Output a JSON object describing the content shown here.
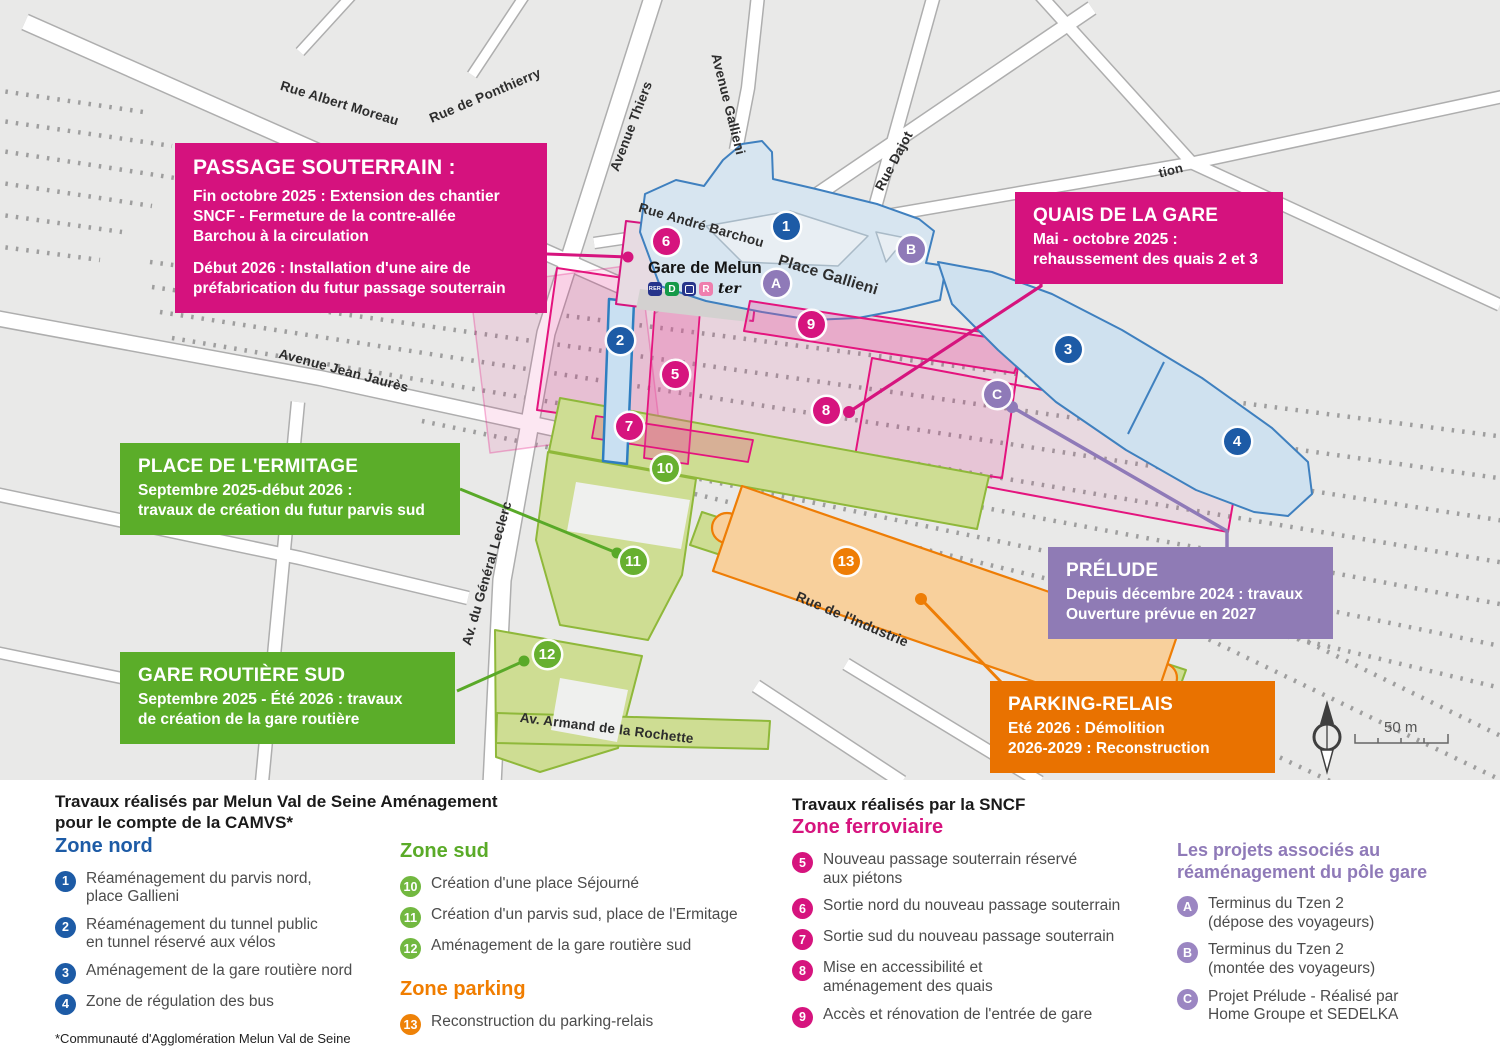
{
  "colors": {
    "blue": "#1d5ba6",
    "pink": "#d6147e",
    "green": "#67b02f",
    "orange": "#ee7d05",
    "purple": "#8f7ab8"
  },
  "map": {
    "scale_label": "50 m",
    "station": {
      "name": "Gare de Melun",
      "rer": "RER",
      "line_d": "D",
      "transilien_r": "R",
      "ter": "ter"
    },
    "street_labels": [
      {
        "text": "Rue Albert Moreau",
        "x": 283,
        "y": 78,
        "rot": 17,
        "size": 13.5
      },
      {
        "text": "Rue de Ponthierry",
        "x": 427,
        "y": 112,
        "rot": -23,
        "size": 13.5
      },
      {
        "text": "Avenue Thiers",
        "x": 607,
        "y": 168,
        "rot": -69,
        "size": 13.5
      },
      {
        "text": "Avenue Gallieni",
        "x": 723,
        "y": 52,
        "rot": 76,
        "size": 13.5
      },
      {
        "text": "Rue Dajot",
        "x": 872,
        "y": 186,
        "rot": -62,
        "size": 13.5
      },
      {
        "text": "Rue André Barchou",
        "x": 641,
        "y": 200,
        "rot": 16,
        "size": 13.5
      },
      {
        "text": "Place Gallieni",
        "x": 781,
        "y": 252,
        "rot": 17,
        "size": 15.5
      },
      {
        "text": "Avenue Jean Jaurès",
        "x": 281,
        "y": 346,
        "rot": 15,
        "size": 13.5
      },
      {
        "text": "Av. du Général Leclerc",
        "x": 459,
        "y": 643,
        "rot": -74,
        "size": 13.5
      },
      {
        "text": "Rue de l'Industrie",
        "x": 800,
        "y": 588,
        "rot": 23,
        "size": 14
      },
      {
        "text": "Av. Armand de la Rochette",
        "x": 521,
        "y": 710,
        "rot": 7,
        "size": 13.5
      },
      {
        "text": "tion",
        "x": 1157,
        "y": 166,
        "rot": -14,
        "size": 13
      }
    ],
    "markers": [
      {
        "label": "1",
        "x": 786,
        "y": 226,
        "color": "blue"
      },
      {
        "label": "2",
        "x": 620,
        "y": 340,
        "color": "blue"
      },
      {
        "label": "3",
        "x": 1068,
        "y": 349,
        "color": "blue"
      },
      {
        "label": "4",
        "x": 1237,
        "y": 441,
        "color": "blue"
      },
      {
        "label": "5",
        "x": 675,
        "y": 374,
        "color": "pink"
      },
      {
        "label": "6",
        "x": 666,
        "y": 241,
        "color": "pink"
      },
      {
        "label": "7",
        "x": 629,
        "y": 426,
        "color": "pink"
      },
      {
        "label": "8",
        "x": 826,
        "y": 410,
        "color": "pink"
      },
      {
        "label": "9",
        "x": 811,
        "y": 324,
        "color": "pink"
      },
      {
        "label": "10",
        "x": 665,
        "y": 468,
        "color": "green"
      },
      {
        "label": "11",
        "x": 633,
        "y": 561,
        "color": "green"
      },
      {
        "label": "12",
        "x": 547,
        "y": 654,
        "color": "green"
      },
      {
        "label": "13",
        "x": 846,
        "y": 561,
        "color": "orange"
      },
      {
        "label": "A",
        "x": 776,
        "y": 283,
        "color": "purple"
      },
      {
        "label": "B",
        "x": 911,
        "y": 249,
        "color": "purple"
      },
      {
        "label": "C",
        "x": 997,
        "y": 394,
        "color": "purple"
      }
    ]
  },
  "callouts": {
    "passage": {
      "title": "PASSAGE SOUTERRAIN :",
      "body1": "Fin octobre 2025 : Extension des chantier\nSNCF - Fermeture de la contre-allée\nBarchou à la circulation",
      "body2": "Début 2026 : Installation d'une aire de\npréfabrication du futur passage souterrain"
    },
    "quais": {
      "title": "QUAIS DE LA GARE",
      "body1": "Mai - octobre 2025 :\nrehaussement des quais 2 et 3"
    },
    "ermitage": {
      "title": "PLACE DE L'ERMITAGE",
      "body1": "Septembre 2025-début 2026 :\n travaux de création du futur parvis sud"
    },
    "routiere": {
      "title": "GARE ROUTIÈRE SUD",
      "body1": "Septembre 2025 - Été 2026 : travaux\nde création de la gare routière"
    },
    "prelude": {
      "title": "PRÉLUDE",
      "body1": "Depuis décembre 2024 : travaux\nOuverture prévue en 2027"
    },
    "parking": {
      "title": "PARKING-RELAIS",
      "body1": "Eté 2026 : Démolition\n2026-2029 : Reconstruction"
    }
  },
  "legend": {
    "left_title": "Travaux réalisés par Melun Val de Seine Aménagement\npour le compte de la CAMVS*",
    "sncf_title": "Travaux réalisés par la SNCF",
    "footnote": "*Communauté d'Agglomération Melun Val de Seine",
    "sections": [
      {
        "id": "zone-nord",
        "heading": "Zone nord",
        "color": "#1d5ba6",
        "chip": "#1d5ba6",
        "col": "1",
        "items": [
          {
            "n": "1",
            "text": "Réaménagement du parvis nord,\nplace Gallieni"
          },
          {
            "n": "2",
            "text": "Réaménagement du tunnel public\nen tunnel réservé aux vélos"
          },
          {
            "n": "3",
            "text": "Aménagement de la gare routière nord"
          },
          {
            "n": "4",
            "text": "Zone de régulation des bus"
          }
        ]
      },
      {
        "id": "zone-sud",
        "heading": "Zone sud",
        "color": "#5aab28",
        "chip": "#72b840",
        "col": "2",
        "items": [
          {
            "n": "10",
            "text": "Création d'une place Séjourné"
          },
          {
            "n": "11",
            "text": "Création d'un parvis sud, place de l'Ermitage"
          },
          {
            "n": "12",
            "text": "Aménagement de la gare routière sud"
          }
        ]
      },
      {
        "id": "zone-parking",
        "heading": "Zone parking",
        "color": "#f07d00",
        "chip": "#ee8208",
        "col": "2",
        "items": [
          {
            "n": "13",
            "text": "Reconstruction du parking-relais"
          }
        ]
      },
      {
        "id": "zone-ferroviaire",
        "heading": "Zone ferroviaire",
        "color": "#d6147e",
        "chip": "#d6147e",
        "col": "3",
        "items": [
          {
            "n": "5",
            "text": "Nouveau passage souterrain réservé\naux piétons"
          },
          {
            "n": "6",
            "text": "Sortie nord du nouveau passage souterrain"
          },
          {
            "n": "7",
            "text": "Sortie sud du nouveau passage souterrain"
          },
          {
            "n": "8",
            "text": "Mise en accessibilité et\naménagement des quais"
          },
          {
            "n": "9",
            "text": "Accès et rénovation de l'entrée de gare"
          }
        ]
      },
      {
        "id": "projets-associes",
        "heading": "Les projets associés au\nréaménagement du pôle gare",
        "color": "#8f7ab8",
        "chip": "#9b86c2",
        "col": "4",
        "items": [
          {
            "n": "A",
            "text": "Terminus du Tzen 2\n(dépose des voyageurs)"
          },
          {
            "n": "B",
            "text": "Terminus du Tzen 2\n(montée des voyageurs)"
          },
          {
            "n": "C",
            "text": "Projet Prélude - Réalisé par\nHome Groupe et SEDELKA"
          }
        ]
      }
    ]
  }
}
